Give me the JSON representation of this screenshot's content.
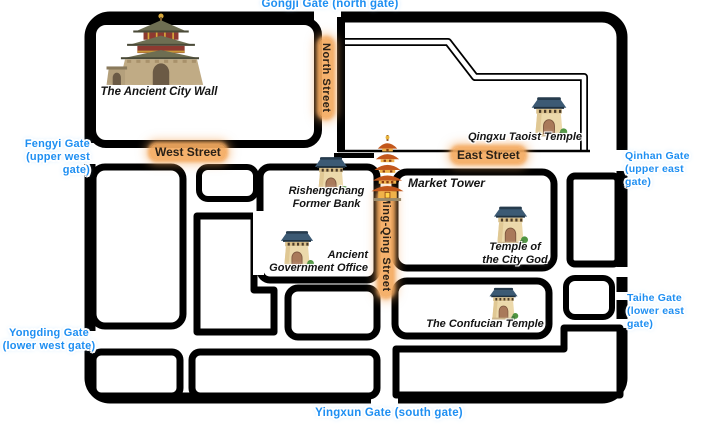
{
  "map": {
    "region_label": "Pingyao-style ancient city map",
    "colors": {
      "background": "#ffffff",
      "map_lines": "#000000",
      "gate_label": "#1e8ff2",
      "street_label_text": "#2a2117",
      "street_label_halo": "#f4aa60"
    }
  },
  "gates": [
    {
      "position": "north",
      "line1": "Gongji Gate (north gate)"
    },
    {
      "position": "upper-west",
      "line1": "Fengyi Gate",
      "line2": "(upper west gate)"
    },
    {
      "position": "upper-east",
      "line1": "Qinhan Gate",
      "line2": "(upper east gate)"
    },
    {
      "position": "lower-west",
      "line1": "Yongding Gate",
      "line2": "(lower west gate)"
    },
    {
      "position": "lower-east",
      "line1": "Taihe Gate",
      "line2": "(lower east gate)"
    },
    {
      "position": "south",
      "line1": "Yingxun Gate (south gate)"
    }
  ],
  "streets": [
    {
      "name": "West Street"
    },
    {
      "name": "North Street"
    },
    {
      "name": "East Street"
    },
    {
      "name": "Ming-Qing Street"
    }
  ],
  "landmarks": [
    {
      "name": "The Ancient City Wall",
      "icon": "city-wall-tower",
      "line1": "The Ancient City Wall"
    },
    {
      "name": "Qingxu Taoist Temple",
      "icon": "gate-tower",
      "line1": "Qingxu Taoist Temple"
    },
    {
      "name": "Market Tower",
      "icon": "pagoda",
      "line1": "Market Tower"
    },
    {
      "name": "Rishengchang Former Bank",
      "icon": "gate-tower",
      "line1": "Rishengchang",
      "line2": "Former Bank"
    },
    {
      "name": "Ancient Government Office",
      "icon": "gate-tower",
      "line1": "Ancient",
      "line2": "Government Office"
    },
    {
      "name": "Temple of the City God",
      "icon": "gate-tower",
      "line1": "Temple of",
      "line2": "the City God"
    },
    {
      "name": "The Confucian Temple",
      "icon": "gate-tower",
      "line1": "The Confucian Temple"
    }
  ]
}
